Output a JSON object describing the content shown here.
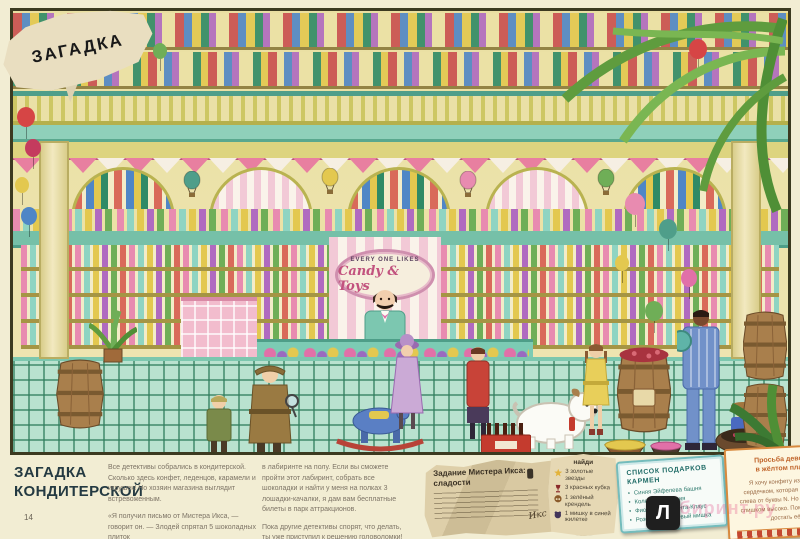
{
  "page": {
    "riddle_label": "ЗАГАДКА",
    "number": "14"
  },
  "illustration": {
    "shop_sign": {
      "line1": "EVERY ONE LIKES",
      "line2": "Candy & Toys"
    }
  },
  "palette": {
    "page_cream": "#f2edd3",
    "wall_yellow": "#ece2a6",
    "floor_teal": "#b9e2cf",
    "maze_line": "#2f7d5c",
    "awning_pink": "#f2c9d6",
    "sign_pink": "#c2527e",
    "counter_teal": "#7ccbb4",
    "note_paper": "#d7c6a0",
    "carmen_border": "#74bcbc",
    "girl_card_border": "#d8893e",
    "logo_bg": "#1f1f1f",
    "watermark_pink": "#e24680"
  },
  "puzzle": {
    "heading_line1": "ЗАГАДКА",
    "heading_line2": "КОНДИТЕРСКОЙ",
    "column1_p1": "Все детективы собрались в кондитерской. Сколько здесь конфет, леденцов, карамели и игрушек! Но хозяин магазина выглядит встревоженным.",
    "column1_p2": "«Я получил письмо от Мистера Икса, — говорит он. — Злодей спрятал 5 шоколадных плиток",
    "column2_p1": "в лабиринте на полу. Если вы сможете пройти этот лабиринт, собрать все шоколадки и найти у меня на полках 3 лошадки-качалки, я дам вам бесплатные билеты в парк аттракционов.",
    "column2_p2": "Пока другие детективы спорят, что делать, ты уже приступил к решению головоломки!"
  },
  "mrx_note": {
    "title": "Задание Мистера Икса:",
    "subtitle": "сладости",
    "signature": "Икс"
  },
  "find_list": {
    "title": "найди",
    "items": [
      {
        "icon": "star-icon",
        "label": "3 золотые звезды"
      },
      {
        "icon": "goblet-icon",
        "label": "3 красных кубка"
      },
      {
        "icon": "pretzel-icon",
        "label": "1 зелёный крендель"
      },
      {
        "icon": "bear-icon",
        "label": "1 мишку в синей жилетке"
      }
    ]
  },
  "carmen_list": {
    "title_line1": "СПИСОК ПОДАРКОВ",
    "title_line2": "КАРМЕН",
    "items": [
      "Синяя Эйфелева башня",
      "Колесо обозрения",
      "Фиолетовый Санта-Клаус",
      "Розовый плюшевый мишка"
    ]
  },
  "girl_request": {
    "title_line1": "Просьба девочки",
    "title_line2": "в жёлтом платье",
    "body": "Я хочу конфету из банки с сердечком, которая находится слева от буквы N. Но банка стоит слишком высоко. Поможешь мне достать её?"
  },
  "watermark": {
    "logo_letter": "Л",
    "site_text": "лабиринт.ру"
  }
}
